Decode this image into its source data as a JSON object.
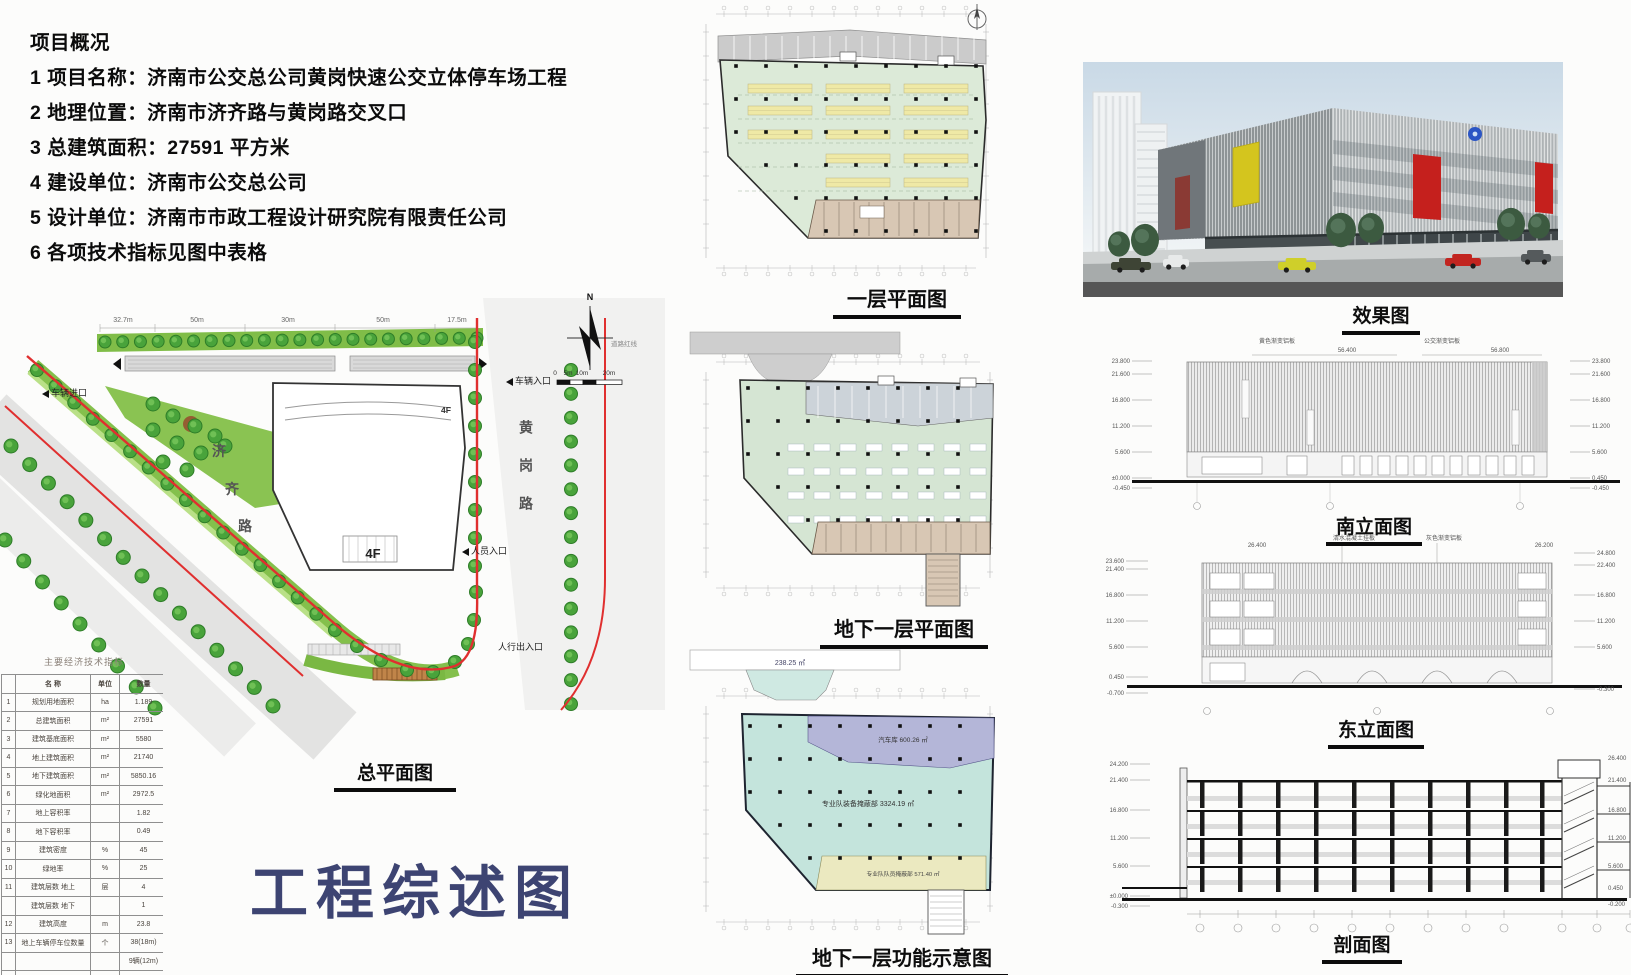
{
  "sheet": {
    "title": "工程综述图"
  },
  "overview": {
    "heading": "项目概况",
    "lines": [
      "1 项目名称：济南市公交总公司黄岗快速公交立体停车场工程",
      "2 地理位置：济南市济齐路与黄岗路交叉口",
      "3 总建筑面积：27591 平方米",
      "4 建设单位：济南市公交总公司",
      "5 设计单位：济南市市政工程设计研究院有限责任公司",
      "6 各项技术指标见图中表格"
    ]
  },
  "site_plan": {
    "caption": "总平面图",
    "road_left_chars": [
      "济",
      "齐",
      "路"
    ],
    "road_right_label": "黄岗路",
    "building_label": "4F",
    "building_label_small": "4F",
    "compass_label": "N",
    "scale_labels": [
      "0",
      "5m",
      "10m",
      "20m"
    ],
    "dim_labels": [
      "32.7m",
      "50m",
      "30m",
      "50m",
      "17.5m"
    ],
    "red_line_label": "道路红线",
    "annotations": {
      "entry_left": "车辆进口",
      "entry_right": "车辆入口",
      "person_entry": "人员入口",
      "person_exit": "人行出入口"
    }
  },
  "indicator_table": {
    "title": "主要经济技术指标",
    "headers": [
      "",
      "名  称",
      "单位",
      "数量"
    ],
    "rows": [
      [
        "1",
        "规划用地面积",
        "ha",
        "1.189"
      ],
      [
        "2",
        "总建筑面积",
        "m²",
        "27591"
      ],
      [
        "3",
        "建筑基底面积",
        "m²",
        "5580"
      ],
      [
        "4",
        "地上建筑面积",
        "m²",
        "21740"
      ],
      [
        "5",
        "地下建筑面积",
        "m²",
        "5850.16"
      ],
      [
        "6",
        "绿化地面积",
        "m²",
        "2972.5"
      ],
      [
        "7",
        "地上容积率",
        "",
        "1.82"
      ],
      [
        "8",
        "地下容积率",
        "",
        "0.49"
      ],
      [
        "9",
        "建筑密度",
        "%",
        "45"
      ],
      [
        "10",
        "绿地率",
        "%",
        "25"
      ],
      [
        "11",
        "建筑层数 地上",
        "层",
        "4"
      ],
      [
        "",
        "建筑层数 地下",
        "",
        "1"
      ],
      [
        "12",
        "建筑高度",
        "m",
        "23.8"
      ],
      [
        "13",
        "地上车辆停车位数量",
        "个",
        "38(18m)"
      ],
      [
        "",
        "",
        "",
        "9辆(12m)"
      ],
      [
        "14",
        "地下车辆停车位数量",
        "个",
        "26(12m)"
      ],
      [
        "15",
        "小汽车停车位数量",
        "个",
        ""
      ]
    ]
  },
  "plans": {
    "first_floor": {
      "caption": "一层平面图"
    },
    "basement": {
      "caption": "地下一层平面图"
    },
    "basement_function": {
      "caption": "地下一层功能示意图",
      "zones": {
        "ramp": "238.25 ㎡",
        "garage": "汽车库 600.26 ㎡",
        "equipment_hall": "专业队装备掩蔽部 3324.19 ㎡",
        "personnel": "专业队队员掩蔽部 571.40 ㎡"
      }
    }
  },
  "render_view": {
    "caption": "效果图"
  },
  "south_elevation": {
    "caption": "南立面图",
    "top_notes": [
      "黄色渐变铝板",
      "56.400",
      "公交渐变铝板",
      "56.800"
    ],
    "levels_left": [
      "23.800",
      "21.600",
      "16.800",
      "11.200",
      "5.600",
      "±0.000",
      "-0.450"
    ],
    "levels_right": [
      "23.800",
      "21.600",
      "16.800",
      "11.200",
      "5.600",
      "0.450",
      "-0.450"
    ]
  },
  "east_elevation": {
    "caption": "东立面图",
    "top_notes": [
      "26.400",
      "清水混凝土挂板",
      "灰色渐变铝板",
      "26.200"
    ],
    "levels_left": [
      "23.600",
      "21.400",
      "16.800",
      "11.200",
      "5.600",
      "0.450",
      "-0.700"
    ],
    "levels_right": [
      "24.800",
      "22.400",
      "16.800",
      "11.200",
      "5.600",
      "-0.300"
    ]
  },
  "section": {
    "caption": "剖面图",
    "levels_left": [
      "24.200",
      "21.400",
      "16.800",
      "11.200",
      "5.600",
      "±0.000",
      "-0.300"
    ],
    "levels_right": [
      "26.400",
      "21.400",
      "16.800",
      "11.200",
      "5.600",
      "0.450",
      "-0.200"
    ]
  }
}
